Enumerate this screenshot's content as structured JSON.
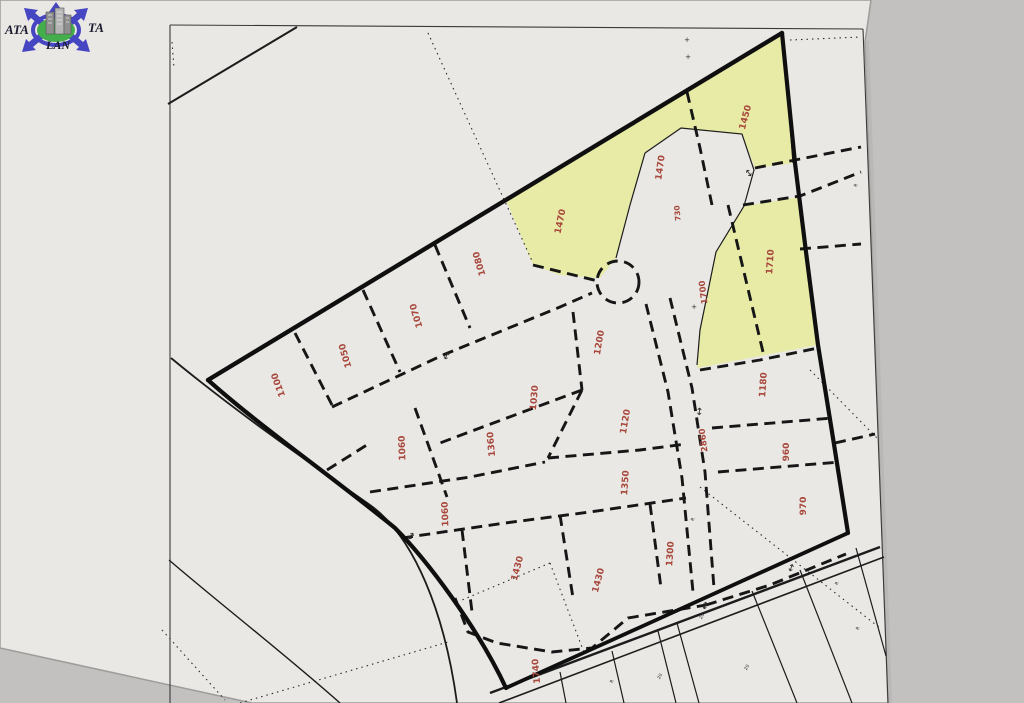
{
  "document": {
    "kind": "cadastral-parcel-map-photo",
    "highlight_note": "three parcels highlighted yellow"
  },
  "colors": {
    "background": "#c2c1bf",
    "paper": "#e9e8e4",
    "paper_edge": "#9d9c9a",
    "line": "#1c1c1c",
    "frame": "#3a3a3a",
    "highlight_yellow": "#e7eba6",
    "label_red": "#a8473c",
    "mark_black": "#2a2a2a",
    "logo_blue": "#4646c2",
    "logo_green": "#44ad4c",
    "logo_gray": "#9a9a9a"
  },
  "logo": {
    "text_left": "ATA",
    "text_right": "TA",
    "text_bottom": "LAN"
  },
  "parcel_labels": [
    {
      "text": "1450",
      "x": 748,
      "y": 118,
      "rot": -75,
      "size": 9
    },
    {
      "text": "1470",
      "x": 663,
      "y": 168,
      "rot": -82,
      "size": 9
    },
    {
      "text": "1470",
      "x": 563,
      "y": 222,
      "rot": -78,
      "size": 9
    },
    {
      "text": "730",
      "x": 680,
      "y": 213,
      "rot": -95,
      "size": 7.5
    },
    {
      "text": "1710",
      "x": 773,
      "y": 262,
      "rot": -86,
      "size": 9
    },
    {
      "text": "1700",
      "x": 706,
      "y": 292,
      "rot": -97,
      "size": 8.5
    },
    {
      "text": "1080",
      "x": 482,
      "y": 263,
      "rot": -106,
      "size": 9
    },
    {
      "text": "1070",
      "x": 419,
      "y": 315,
      "rot": -106,
      "size": 9
    },
    {
      "text": "1050",
      "x": 348,
      "y": 355,
      "rot": -106,
      "size": 9
    },
    {
      "text": "1100",
      "x": 281,
      "y": 384,
      "rot": -110,
      "size": 9
    },
    {
      "text": "1200",
      "x": 602,
      "y": 343,
      "rot": -80,
      "size": 9
    },
    {
      "text": "1030",
      "x": 537,
      "y": 398,
      "rot": -85,
      "size": 9
    },
    {
      "text": "1120",
      "x": 628,
      "y": 422,
      "rot": -80,
      "size": 9
    },
    {
      "text": "1360",
      "x": 494,
      "y": 444,
      "rot": -95,
      "size": 9
    },
    {
      "text": "1180",
      "x": 766,
      "y": 385,
      "rot": -86,
      "size": 9
    },
    {
      "text": "2860",
      "x": 706,
      "y": 440,
      "rot": -97,
      "size": 8.5
    },
    {
      "text": "960",
      "x": 789,
      "y": 452,
      "rot": -90,
      "size": 9
    },
    {
      "text": "970",
      "x": 806,
      "y": 506,
      "rot": -90,
      "size": 9
    },
    {
      "text": "1060",
      "x": 405,
      "y": 448,
      "rot": -92,
      "size": 9
    },
    {
      "text": "1350",
      "x": 628,
      "y": 483,
      "rot": -86,
      "size": 9
    },
    {
      "text": "1060",
      "x": 448,
      "y": 514,
      "rot": -92,
      "size": 9
    },
    {
      "text": "1430",
      "x": 520,
      "y": 569,
      "rot": -75,
      "size": 9
    },
    {
      "text": "1430",
      "x": 601,
      "y": 581,
      "rot": -75,
      "size": 9
    },
    {
      "text": "1300",
      "x": 673,
      "y": 554,
      "rot": -86,
      "size": 9
    },
    {
      "text": "1740",
      "x": 539,
      "y": 671,
      "rot": -95,
      "size": 9
    }
  ],
  "small_marks": [
    {
      "text": "+",
      "x": 687,
      "y": 42,
      "rot": 0,
      "size": 7
    },
    {
      "text": "+",
      "x": 688,
      "y": 59,
      "rot": 0,
      "size": 7
    },
    {
      "text": "+",
      "x": 694,
      "y": 309,
      "rot": 0,
      "size": 7
    },
    {
      "text": "R",
      "x": 857,
      "y": 186,
      "rot": -60,
      "size": 4.5
    },
    {
      "text": "20",
      "x": 703,
      "y": 617,
      "rot": -60,
      "size": 4.5
    },
    {
      "text": "20",
      "x": 748,
      "y": 668,
      "rot": -60,
      "size": 4.5
    },
    {
      "text": "20",
      "x": 661,
      "y": 677,
      "rot": -60,
      "size": 4.5
    },
    {
      "text": "R",
      "x": 613,
      "y": 682,
      "rot": -60,
      "size": 4.5
    },
    {
      "text": "R",
      "x": 838,
      "y": 584,
      "rot": -60,
      "size": 4.5
    },
    {
      "text": "R",
      "x": 859,
      "y": 629,
      "rot": -60,
      "size": 4.5
    },
    {
      "text": "R",
      "x": 694,
      "y": 520,
      "rot": -60,
      "size": 4.5
    },
    {
      "text": "↕",
      "x": 751,
      "y": 176,
      "rot": -35,
      "size": 10
    },
    {
      "text": "↕",
      "x": 699,
      "y": 415,
      "rot": 5,
      "size": 10
    },
    {
      "text": "↕",
      "x": 409,
      "y": 539,
      "rot": 35,
      "size": 10
    },
    {
      "text": "↕",
      "x": 704,
      "y": 609,
      "rot": 15,
      "size": 10
    },
    {
      "text": "↕",
      "x": 445,
      "y": 359,
      "rot": 25,
      "size": 10
    },
    {
      "text": "↕",
      "x": 790,
      "y": 571,
      "rot": 20,
      "size": 10
    }
  ]
}
